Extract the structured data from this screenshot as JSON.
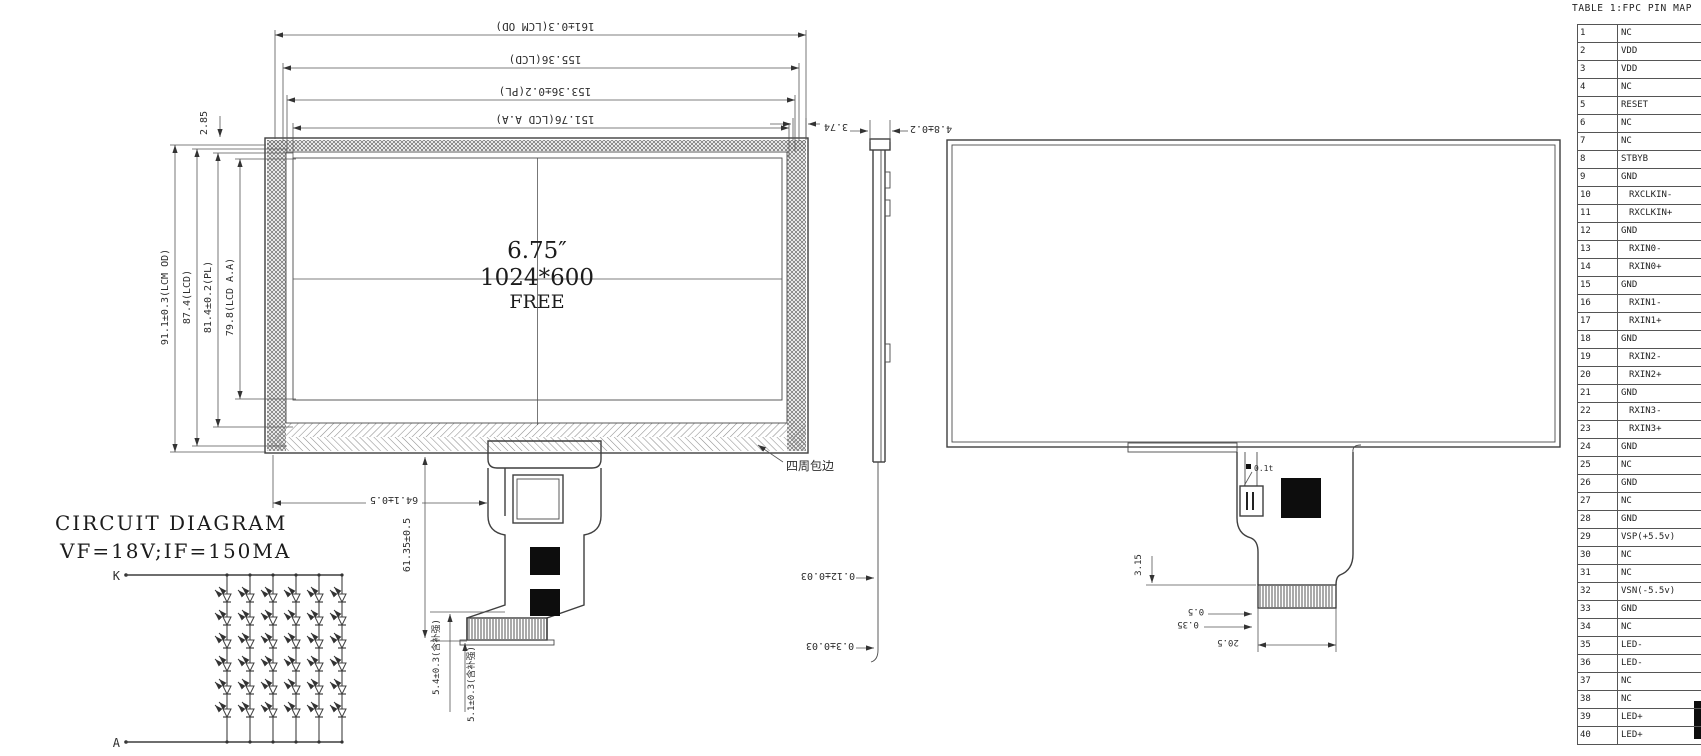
{
  "front_view": {
    "center": {
      "size": "6.75″",
      "resolution": "1024*600",
      "brand": "FREE"
    },
    "dims_top": [
      "161±0.3(LCM OD)",
      "155.36(LCD)",
      "153.36±0.2(PL)",
      "151.76(LCD A.A)"
    ],
    "dims_left": [
      "91.1±0.3(LCM OD)",
      "87.4(LCD)",
      "81.4±0.2(PL)",
      "79.8(LCD A.A)"
    ],
    "dim_gap": "2.85",
    "dim_tail_x": "64.1±0.5",
    "dim_tail_y": "61.35±0.5",
    "dim_tail_b1": "5.4±0.3(含补强)",
    "dim_tail_b2": "5.1±0.3(含补强)",
    "label_edge_wrap": "四周包边"
  },
  "side_view": {
    "dim_top1": "3.74",
    "dim_top2": "4.8±0.2",
    "dim_bottom1": "0.12±0.03",
    "dim_bottom2": "0.3±0.03"
  },
  "rear_view": {
    "dim_comb": "3.15",
    "dim_b1": "0.5",
    "dim_b2": "0.35",
    "dim_b3": "20.5",
    "ic_label": "0.1t"
  },
  "circuit": {
    "title": "CIRCUIT DIAGRAM",
    "subtitle": "VF=18V;IF=150MA",
    "cathode": "K",
    "anode": "A",
    "columns": 6,
    "leds_per_column": 6
  },
  "table": {
    "title": "TABLE 1:FPC PIN MAP",
    "rows": [
      {
        "n": "1",
        "name": "NC",
        "indent": false
      },
      {
        "n": "2",
        "name": "VDD",
        "indent": false
      },
      {
        "n": "3",
        "name": "VDD",
        "indent": false
      },
      {
        "n": "4",
        "name": "NC",
        "indent": false
      },
      {
        "n": "5",
        "name": "RESET",
        "indent": false
      },
      {
        "n": "6",
        "name": "NC",
        "indent": false
      },
      {
        "n": "7",
        "name": "NC",
        "indent": false
      },
      {
        "n": "8",
        "name": "STBYB",
        "indent": false
      },
      {
        "n": "9",
        "name": "GND",
        "indent": false
      },
      {
        "n": "10",
        "name": "RXCLKIN-",
        "indent": true
      },
      {
        "n": "11",
        "name": "RXCLKIN+",
        "indent": true
      },
      {
        "n": "12",
        "name": "GND",
        "indent": false
      },
      {
        "n": "13",
        "name": "RXIN0-",
        "indent": true
      },
      {
        "n": "14",
        "name": "RXIN0+",
        "indent": true
      },
      {
        "n": "15",
        "name": "GND",
        "indent": false
      },
      {
        "n": "16",
        "name": "RXIN1-",
        "indent": true
      },
      {
        "n": "17",
        "name": "RXIN1+",
        "indent": true
      },
      {
        "n": "18",
        "name": "GND",
        "indent": false
      },
      {
        "n": "19",
        "name": "RXIN2-",
        "indent": true
      },
      {
        "n": "20",
        "name": "RXIN2+",
        "indent": true
      },
      {
        "n": "21",
        "name": "GND",
        "indent": false
      },
      {
        "n": "22",
        "name": "RXIN3-",
        "indent": true
      },
      {
        "n": "23",
        "name": "RXIN3+",
        "indent": true
      },
      {
        "n": "24",
        "name": "GND",
        "indent": false
      },
      {
        "n": "25",
        "name": "NC",
        "indent": false
      },
      {
        "n": "26",
        "name": "GND",
        "indent": false
      },
      {
        "n": "27",
        "name": "NC",
        "indent": false
      },
      {
        "n": "28",
        "name": "GND",
        "indent": false
      },
      {
        "n": "29",
        "name": "VSP(+5.5v)",
        "indent": false
      },
      {
        "n": "30",
        "name": "NC",
        "indent": false
      },
      {
        "n": "31",
        "name": "NC",
        "indent": false
      },
      {
        "n": "32",
        "name": "VSN(-5.5v)",
        "indent": false
      },
      {
        "n": "33",
        "name": "GND",
        "indent": false
      },
      {
        "n": "34",
        "name": "NC",
        "indent": false
      },
      {
        "n": "35",
        "name": "LED-",
        "indent": false
      },
      {
        "n": "36",
        "name": "LED-",
        "indent": false
      },
      {
        "n": "37",
        "name": "NC",
        "indent": false
      },
      {
        "n": "38",
        "name": "NC",
        "indent": false
      },
      {
        "n": "39",
        "name": "LED+",
        "indent": false
      },
      {
        "n": "40",
        "name": "LED+",
        "indent": false
      }
    ]
  }
}
